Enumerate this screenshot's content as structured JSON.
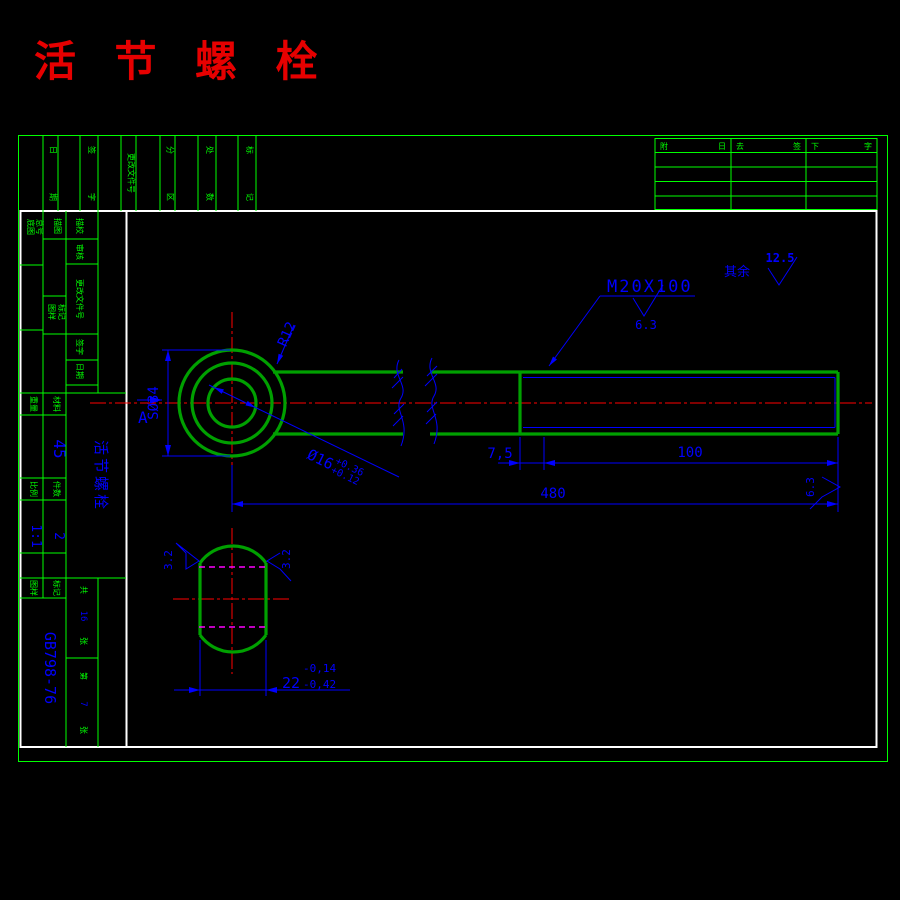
{
  "title": {
    "text": "活 节 螺 栓"
  },
  "rev_strip": {
    "cols": [
      {
        "top": "日",
        "bottom": "期"
      },
      {
        "top": "签",
        "bottom": "字"
      },
      {
        "stack": "更改文件号"
      },
      {
        "top": "分",
        "bottom": "区"
      },
      {
        "top": "处",
        "bottom": "数"
      },
      {
        "top": "标",
        "bottom": "记"
      }
    ]
  },
  "sig_table": {
    "headers": [
      {
        "l": "附",
        "r": "日"
      },
      {
        "l": "去",
        "r": "签"
      },
      {
        "l": "下",
        "r": "字"
      }
    ]
  },
  "title_block": {
    "labels": {
      "ditu": "底图",
      "zonghao": "总号",
      "miaotu": "描图",
      "miaojiao": "描校",
      "shenhe": "审核",
      "genggai": "更改文件号",
      "tuyang": "图样",
      "biaoji": "标记",
      "qianzi": "签字",
      "riqi": "日期",
      "zhongliang": "重量",
      "cailiao": "材料",
      "bili": "比例",
      "jianshu": "件数",
      "b1": "图样",
      "b2": "标记"
    },
    "values": {
      "material": "45",
      "scale": "1:1",
      "qty": "2",
      "part_name": "活节螺栓",
      "std_no": "GB798-76"
    },
    "sheets": {
      "gong": "共",
      "total": "16",
      "zhang1": "张",
      "di": "第",
      "num": "7",
      "zhang2": "张"
    }
  },
  "drawing": {
    "dims": {
      "thread": "M20X100",
      "sphere": "SØ34",
      "r12": "R12",
      "hole": "Ø16",
      "hole_up": "+0.36",
      "hole_lo": "+0.12",
      "seg": "7,5",
      "thread_len": "100",
      "total": "480",
      "width": "22",
      "w_up": "-0,14",
      "w_lo": "-0,42",
      "section": "A"
    },
    "rough": {
      "rest_label": "其余",
      "rest": "12.5",
      "thread": "6.3",
      "end": "6.3",
      "side_l": "3.2",
      "side_r": "3.2"
    }
  }
}
